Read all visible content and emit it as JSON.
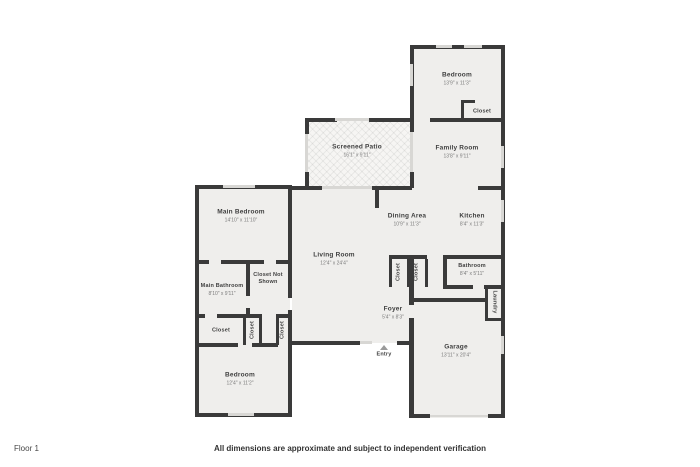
{
  "title": "Floor plan",
  "colors": {
    "wall": "#3a3a3a",
    "room_fill": "#efeeec",
    "window": "#d8d7d4",
    "background": "#ffffff"
  },
  "footer": {
    "floor_label": "Floor 1",
    "disclaimer": "All dimensions are approximate and subject to independent verification"
  },
  "rooms": {
    "bedroom_tr": {
      "name": "Bedroom",
      "dims": "13'9\" x 11'3\""
    },
    "closet_tr": {
      "name": "Closet"
    },
    "family_room": {
      "name": "Family Room",
      "dims": "13'8\" x 9'11\""
    },
    "screened_patio": {
      "name": "Screened Patio",
      "dims": "16'1\" x 9'11\""
    },
    "main_bedroom": {
      "name": "Main Bedroom",
      "dims": "14'10\" x 11'10\""
    },
    "dining_area": {
      "name": "Dining Area",
      "dims": "10'9\" x 11'3\""
    },
    "kitchen": {
      "name": "Kitchen",
      "dims": "8'4\" x 11'3\""
    },
    "living_room": {
      "name": "Living Room",
      "dims": "12'4\" x 24'4\""
    },
    "closet_not_shown": {
      "name": "Closet Not Shown"
    },
    "main_bathroom": {
      "name": "Main Bathroom",
      "dims": "8'10\" x 9'11\""
    },
    "bathroom": {
      "name": "Bathroom",
      "dims": "8'4\" x 5'11\""
    },
    "laundry": {
      "name": "Laundry"
    },
    "closet_foyer_1": {
      "name": "Closet"
    },
    "closet_foyer_2": {
      "name": "Closet"
    },
    "foyer": {
      "name": "Foyer",
      "dims": "5'4\" x 8'3\""
    },
    "entry": {
      "name": "Entry"
    },
    "garage": {
      "name": "Garage",
      "dims": "13'11\" x 20'4\""
    },
    "closet_hall": {
      "name": "Closet"
    },
    "closet_v1": {
      "name": "Closet"
    },
    "closet_v2": {
      "name": "Closet"
    },
    "bedroom_bl": {
      "name": "Bedroom",
      "dims": "12'4\" x 11'2\""
    }
  }
}
